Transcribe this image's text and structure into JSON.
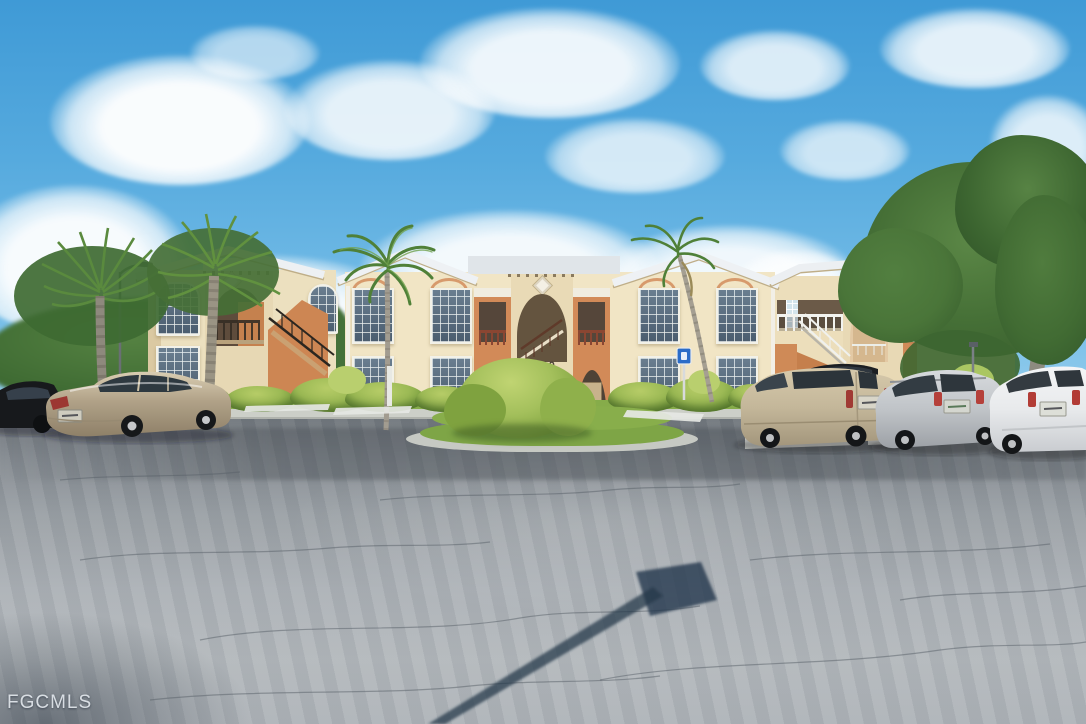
{
  "meta": {
    "kind": "real-estate listing photograph",
    "description": "Two-story cream stucco condo buildings with salmon stairwell accents and white roofs, palm trees and tropical landscaping, six parked vehicles, and a large asphalt parking lot with a street-sign shadow under a blue sky with puffy clouds"
  },
  "watermark": {
    "text": "FGCMLS"
  },
  "building": {
    "number": "4110"
  },
  "signs": {
    "handicap_parking": "blue handicap parking sign on post"
  },
  "palette": {
    "sky_top": "#3f9ad6",
    "sky_horizon": "#cfe9f6",
    "cloud": "#ffffff",
    "wall_cream": "#f0e4c4",
    "wall_shadow": "#dbc9a2",
    "accent_salmon": "#d28a58",
    "roof_white": "#edf0f3",
    "window_glass": "#46586a",
    "door_tan": "#c8b28c",
    "foliage_dark": "#3f6b33",
    "bush_bright": "#9cba55",
    "grass": "#86ac4a",
    "asphalt_light": "#b3b8bc",
    "asphalt_dark": "#70767c",
    "curb_white": "#d6d8d4",
    "sign_shadow": "#24364a",
    "watermark_gray": "#e9eef3"
  },
  "vehicles": [
    {
      "name": "black car (far left, partial)",
      "color": "#17191c"
    },
    {
      "name": "champagne sedan",
      "color": "#b1a288"
    },
    {
      "name": "tan minivan",
      "color": "#c4b79a"
    },
    {
      "name": "dark car behind minivan",
      "color": "#1b1e22"
    },
    {
      "name": "silver suv",
      "color": "#c0c4c8"
    },
    {
      "name": "white suv",
      "color": "#e8eaec"
    }
  ]
}
